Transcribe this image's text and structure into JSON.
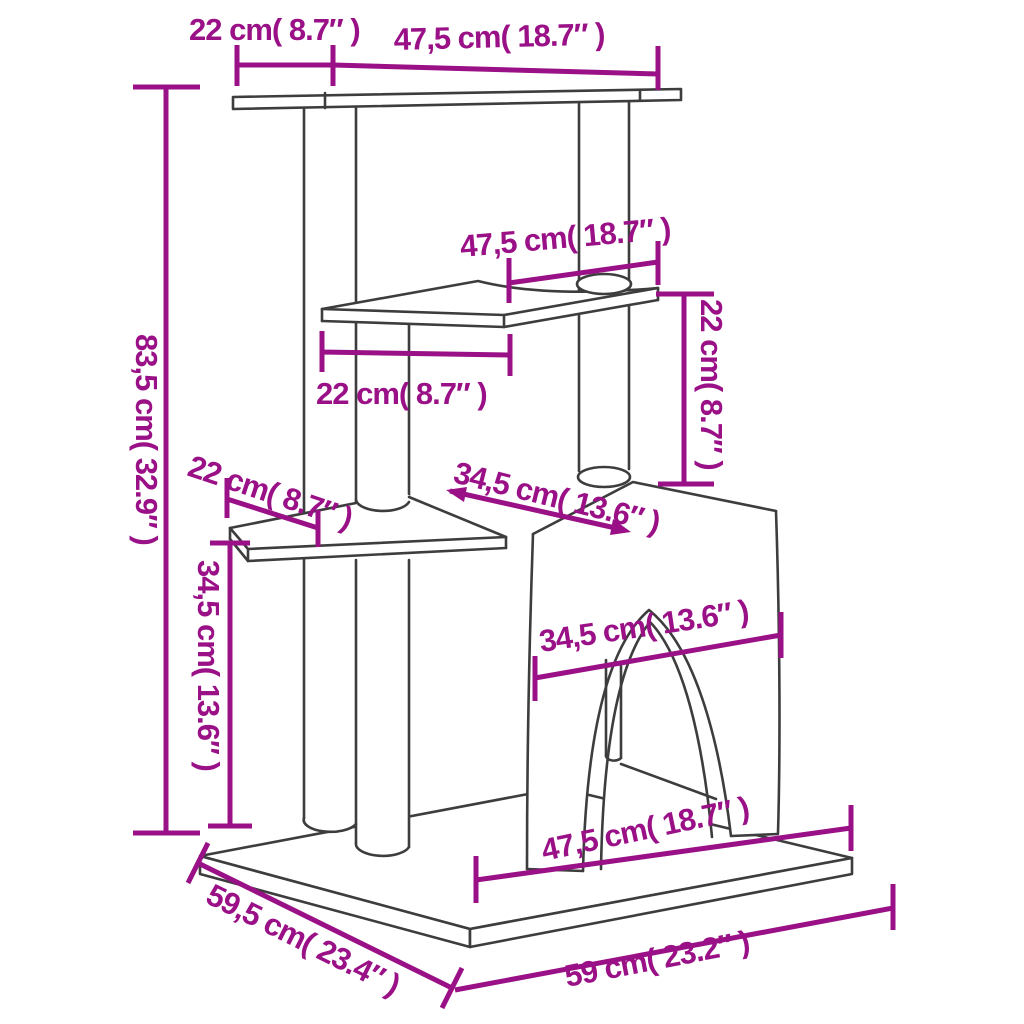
{
  "diagram": {
    "subject": "cat scratching tree with condo house, shelves and posts - dimension drawing",
    "units": {
      "primary": "cm",
      "secondary": "inch"
    },
    "colors": {
      "dimension_annotation": "#9a1086",
      "product_outline": "#3d3d3d",
      "background": "#ffffff"
    }
  },
  "dims": [
    {
      "name": "top-platform-left-width",
      "label": "22 cm( 8.7″ )",
      "cm": 22,
      "inch": 8.7
    },
    {
      "name": "top-platform-right-width",
      "label": "47,5 cm( 18.7″ )",
      "cm": 47.5,
      "inch": 18.7
    },
    {
      "name": "total-height",
      "label": "83,5 cm( 32.9″ )",
      "cm": 83.5,
      "inch": 32.9
    },
    {
      "name": "middle-shelf-width",
      "label": "47,5 cm( 18.7″ )",
      "cm": 47.5,
      "inch": 18.7
    },
    {
      "name": "middle-shelf-depth",
      "label": "22 cm( 8.7″ )",
      "cm": 22,
      "inch": 8.7
    },
    {
      "name": "shelf-to-house-height",
      "label": "22 cm( 8.7″ )",
      "cm": 22,
      "inch": 8.7
    },
    {
      "name": "lower-shelf-depth",
      "label": "22 cm( 8.7″ )",
      "cm": 22,
      "inch": 8.7
    },
    {
      "name": "lower-section-height",
      "label": "34,5 cm( 13.6″ )",
      "cm": 34.5,
      "inch": 13.6
    },
    {
      "name": "house-top-depth",
      "label": "34,5 cm( 13.6″ )",
      "cm": 34.5,
      "inch": 13.6
    },
    {
      "name": "house-front-width",
      "label": "34,5 cm( 13.6″ )",
      "cm": 34.5,
      "inch": 13.6
    },
    {
      "name": "base-front-width",
      "label": "47,5 cm( 18.7″ )",
      "cm": 47.5,
      "inch": 18.7
    },
    {
      "name": "base-depth",
      "label": "59,5 cm( 23.4″ )",
      "cm": 59.5,
      "inch": 23.4
    },
    {
      "name": "base-width",
      "label": "59 cm( 23.2″ )",
      "cm": 59,
      "inch": 23.2
    }
  ]
}
